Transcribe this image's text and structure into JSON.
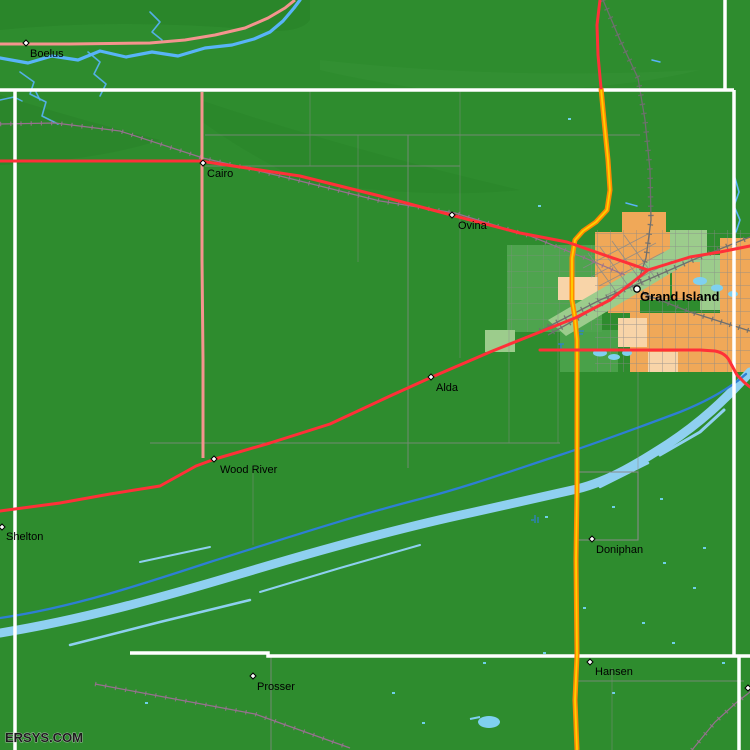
{
  "map": {
    "watermark": "ERSYS.COM",
    "towns": [
      {
        "name": "Boelus",
        "marker": "diamond"
      },
      {
        "name": "Cairo",
        "marker": "diamond"
      },
      {
        "name": "Ovina",
        "marker": "diamond"
      },
      {
        "name": "Grand Island",
        "marker": "circle"
      },
      {
        "name": "Alda",
        "marker": "diamond"
      },
      {
        "name": "Wood River",
        "marker": "diamond"
      },
      {
        "name": "Shelton",
        "marker": "diamond"
      },
      {
        "name": "Doniphan",
        "marker": "diamond"
      },
      {
        "name": "Prosser",
        "marker": "diamond"
      },
      {
        "name": "Hansen",
        "marker": "diamond"
      }
    ],
    "colors": {
      "land": "#2E8C2E",
      "suburban_green": "#4EA44E",
      "park_green": "#9CCC8C",
      "urban_orange": "#F0A858",
      "urban_peach": "#F8D4A8",
      "river_blue": "#58B4F8",
      "braid_blue": "#8FD0F0",
      "channel_blue": "#2E7FD4",
      "pond_cyan": "#6FD0E8",
      "highway_red": "#FF3038",
      "road_salmon": "#F4948E",
      "highway_orange": "#FF8A00",
      "highway_core_yellow": "#FFD000",
      "county_line_white": "#FFFFFF",
      "road_gray": "#8A8A8A",
      "railroad_gray": "#6F6F6F",
      "railroad_mauve": "#97718F"
    }
  }
}
